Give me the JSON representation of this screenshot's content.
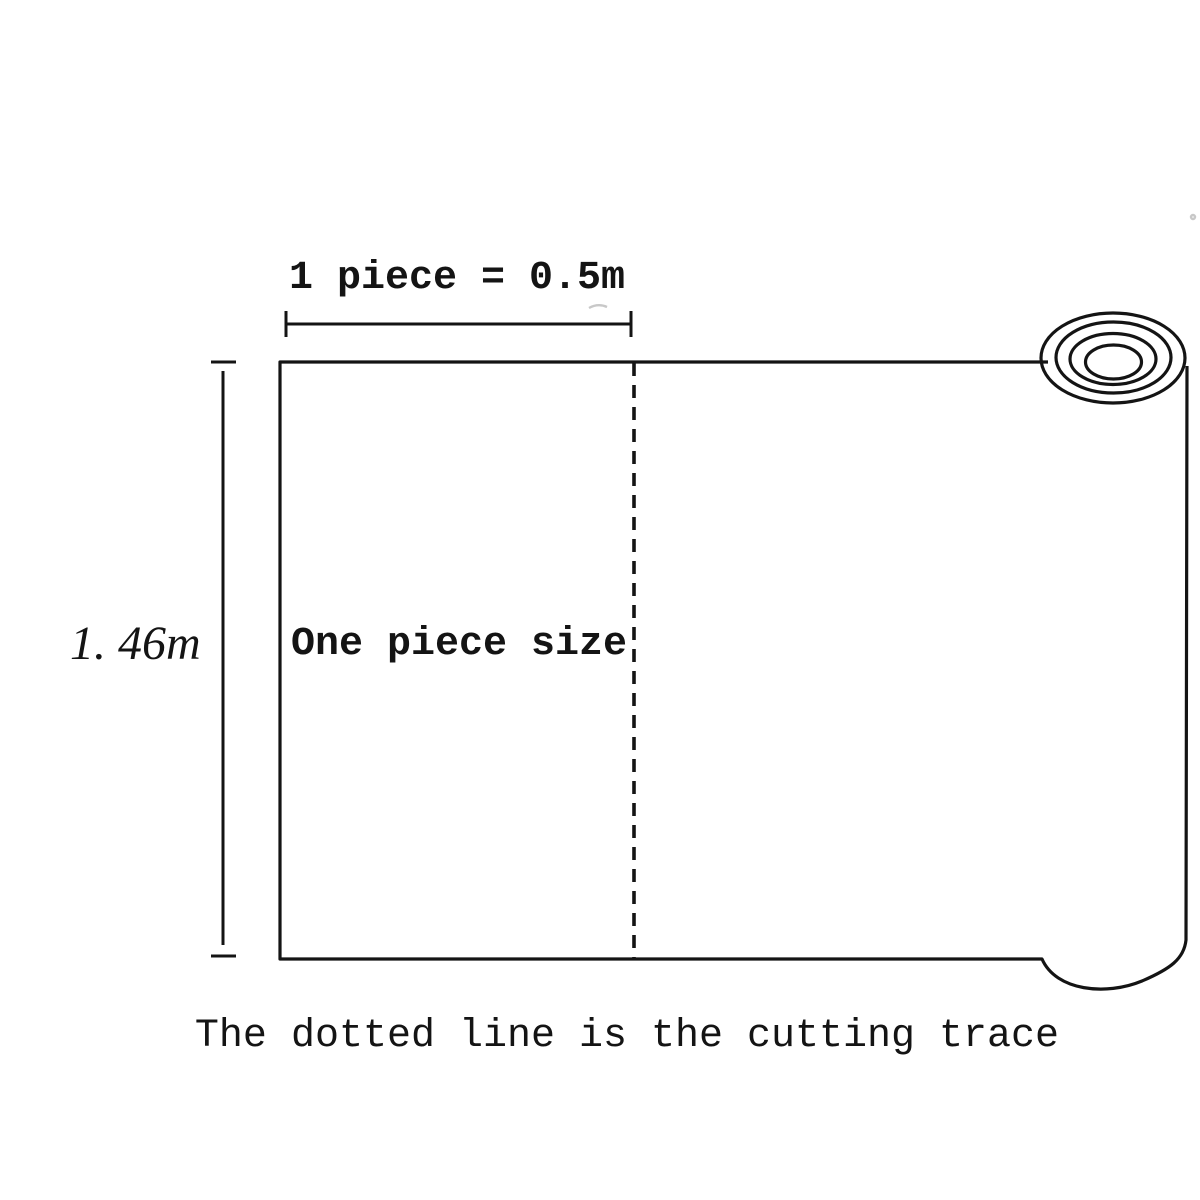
{
  "diagram": {
    "top_dimension_label": "1 piece = 0.5m",
    "left_dimension_label": "1. 46m",
    "piece_label": "One piece size",
    "caption": "The dotted line is the cutting trace",
    "colors": {
      "line": "#141414",
      "background": "#ffffff"
    }
  }
}
